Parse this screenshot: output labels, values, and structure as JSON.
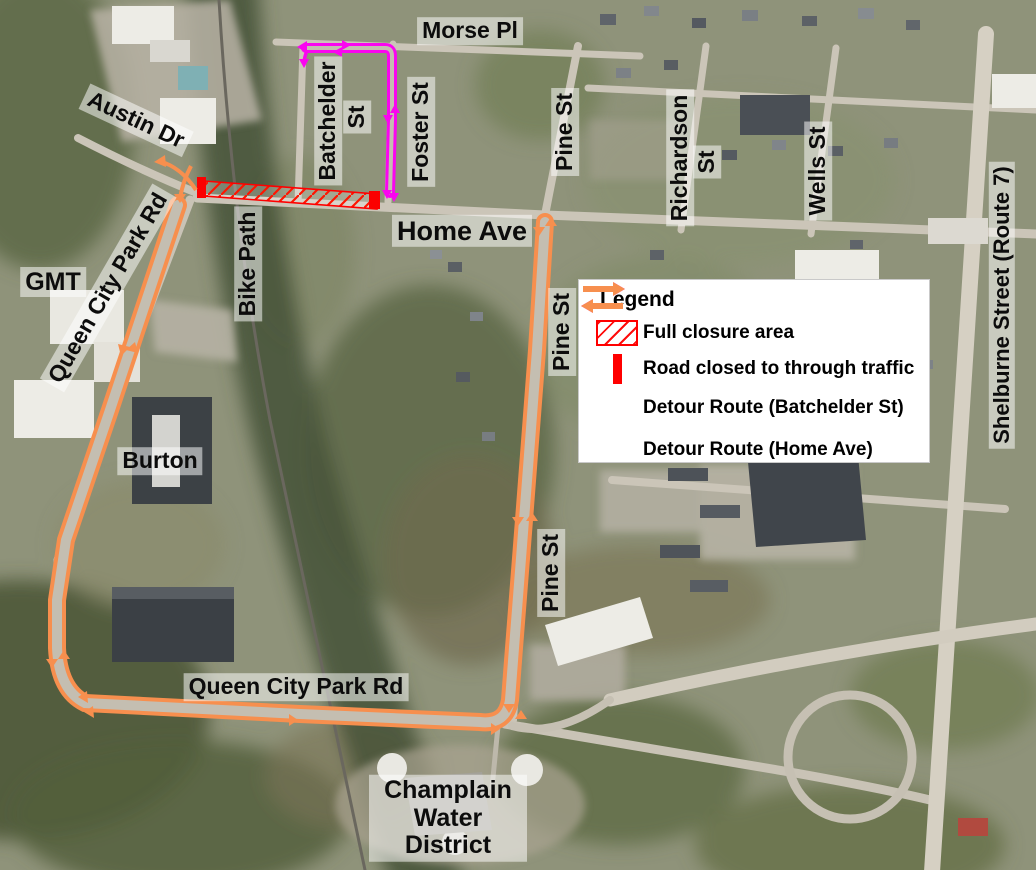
{
  "map": {
    "type": "aerial-detour-map",
    "labels": {
      "morse_pl": "Morse Pl",
      "batchelder": "Batchelder",
      "batchelder_st_suffix": "St",
      "foster_st": "Foster St",
      "pine_st_top": "Pine St",
      "pine_st_mid": "Pine St",
      "pine_st_lower": "Pine St",
      "austin_dr": "Austin Dr",
      "queen_city_park_rd_diagonal": "Queen City Park Rd",
      "queen_city_park_rd_bottom": "Queen City Park Rd",
      "gmt": "GMT",
      "bike_path": "Bike Path",
      "home_ave": "Home Ave",
      "richardson": "Richardson",
      "richardson_st_suffix": "St",
      "wells_st": "Wells St",
      "shelburne": "Shelburne Street (Route 7)",
      "burton": "Burton",
      "champlain_line1": "Champlain",
      "champlain_line2": "Water",
      "champlain_line3": "District"
    }
  },
  "legend": {
    "title": "Legend",
    "items": [
      {
        "label": "Full closure area",
        "symbol": "hatched-area",
        "color": "#ff0000"
      },
      {
        "label": "Road closed to through traffic",
        "symbol": "solid-red-bar",
        "color": "#ff0000"
      },
      {
        "label": "Detour Route (Batchelder St)",
        "symbol": "double-arrow",
        "color": "#fa05f0"
      },
      {
        "label": "Detour Route (Home Ave)",
        "symbol": "double-arrow",
        "color": "#f78f4e"
      }
    ]
  },
  "routes": {
    "full_closure_area": {
      "color": "#ff0000",
      "along": "Home Ave at Bike Path crossing"
    },
    "road_closed_bars": 2,
    "detour_batchelder": {
      "color": "#fa05f0",
      "via": [
        "Foster St",
        "Morse Pl",
        "Batchelder St"
      ]
    },
    "detour_home": {
      "color": "#f78f4e",
      "via": [
        "Queen City Park Rd",
        "Pine St",
        "Home Ave"
      ]
    }
  },
  "colors": {
    "closure_red": "#ff0000",
    "detour_magenta": "#fa05f0",
    "detour_orange": "#f78f4e"
  }
}
